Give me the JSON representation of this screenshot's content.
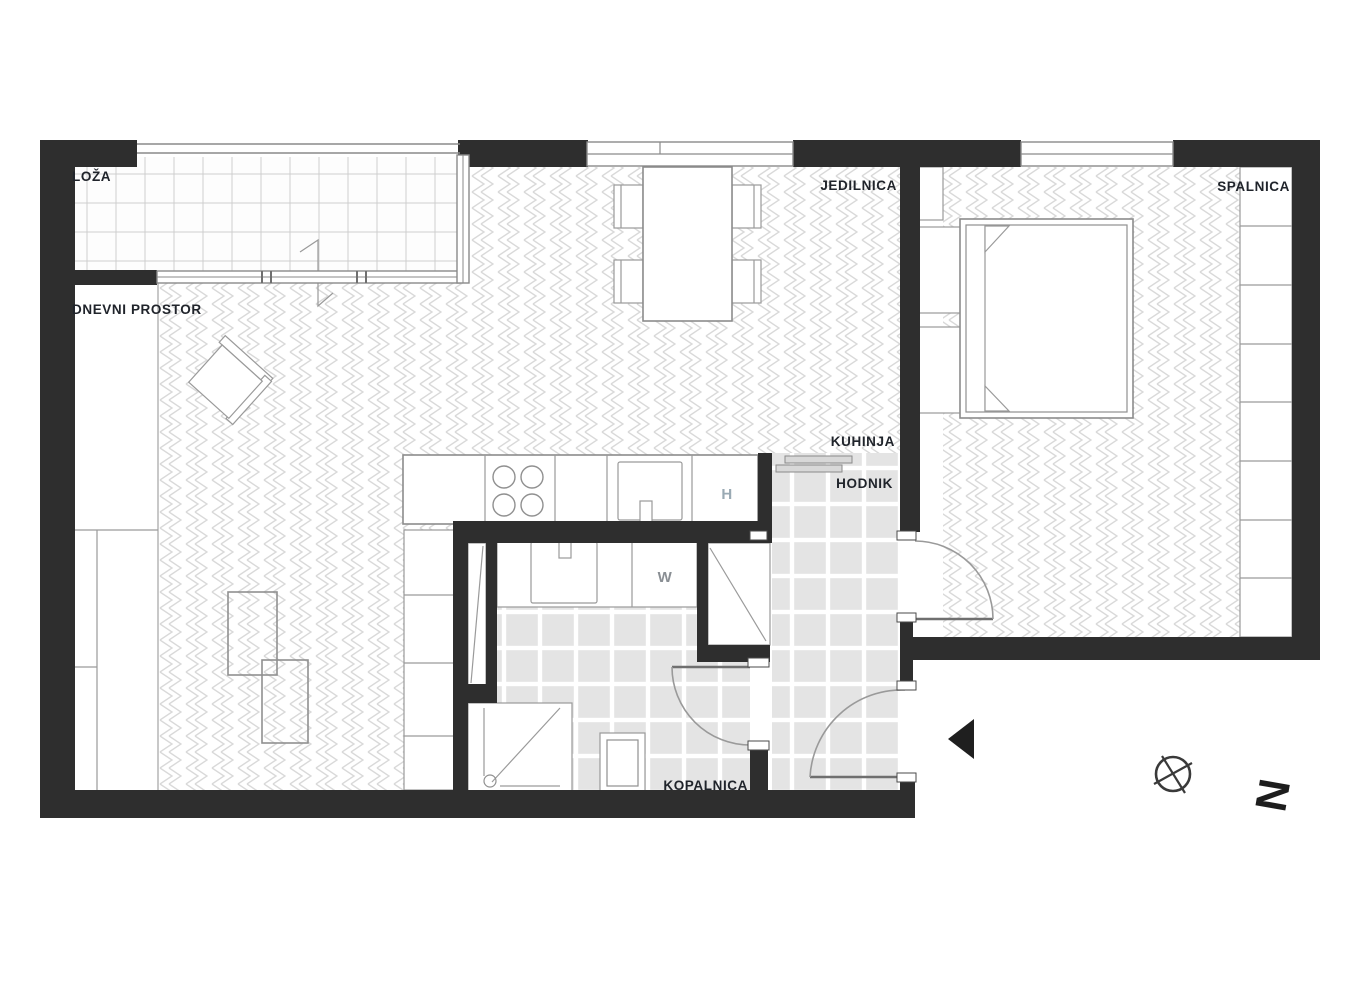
{
  "plan": {
    "rooms": [
      {
        "id": "loza",
        "label": "LOŽA"
      },
      {
        "id": "dnevni-prostor",
        "label": "DNEVNI PROSTOR"
      },
      {
        "id": "jedilnica",
        "label": "JEDILNICA"
      },
      {
        "id": "spalnica",
        "label": "SPALNICA"
      },
      {
        "id": "kuhinja",
        "label": "KUHINJA"
      },
      {
        "id": "hodnik",
        "label": "HODNIK"
      },
      {
        "id": "kopalnica",
        "label": "KOPALNICA"
      }
    ],
    "fixtures": {
      "fridge_label": "H",
      "washer_label": "W"
    },
    "compass": {
      "north_label": "N"
    },
    "colors": {
      "wall": "#2e2e2e",
      "furniture_line": "#8c8c8c",
      "herringbone": "#d9d9d9",
      "tile_fill": "#e4e4e4",
      "label_text": "#20242b",
      "fridge_text": "#9aaab4",
      "washer_text": "#8a8f94"
    }
  }
}
